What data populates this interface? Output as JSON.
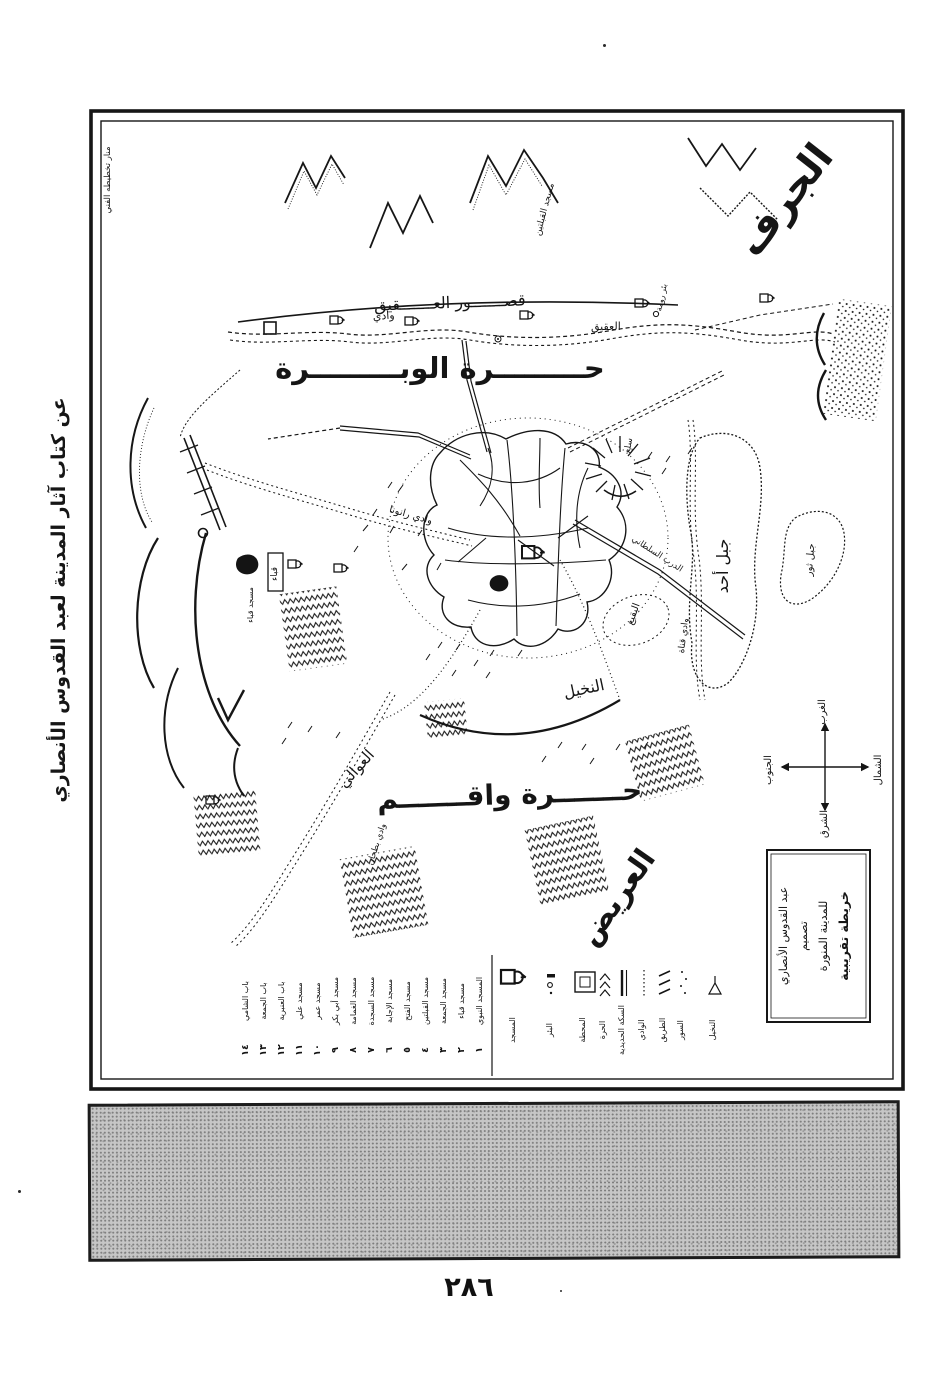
{
  "page": {
    "number": "٢٨٦"
  },
  "colors": {
    "ink": "#1a1a1a",
    "paper": "#ffffff",
    "halftone_bar": "#c6c6c6"
  },
  "margin_caption": "عن كتاب آثار المدينة لعبد القدوس الأنصاري",
  "corner_note": "منار تخطيطه الفني",
  "map": {
    "major_labels": {
      "jurf": "الجرف",
      "qusur_aqiq": "قصـــــــور العـــــــقيق",
      "wadi_word": "وادي",
      "aqiq_word": "العقيق",
      "harrat_wabara": "حـــــــــرة الوبـــــــــرة",
      "harrat_waqim": "حـــــــرة واقـــــــم",
      "awali": "العوالي",
      "arid": "العريض",
      "nakheel": "النخيل",
      "wadi_ranuna": "وادي رانونا",
      "wadi_buthan": "وادي بطحان",
      "wadi_qanat": "وادي قناة",
      "jabal_uhud": "جبل أحد",
      "jabal_thawr": "جبل ثور",
      "jabal_sala": "سلع",
      "quba_box": "قباء",
      "masjid_quba": "مسجد قباء",
      "baqi": "البقيع",
      "qiblatain": "مسجد القبلتين",
      "bir_ruma": "بئر رومة",
      "darb_sultani": "الدرب السلطاني"
    },
    "compass": {
      "north": "الشمال",
      "south": "الجنوب",
      "east": "الشرق",
      "west": "الغرب"
    },
    "cartouche": {
      "line1": "خريطة تقريبية",
      "line2": "للمدينة المنورة",
      "line3": "تصميم",
      "line4": "عبد القدوس الأنصاري"
    },
    "legend": {
      "numbered": [
        {
          "no": "١",
          "label": "المسجد النبوي"
        },
        {
          "no": "٢",
          "label": "مسجد قباء"
        },
        {
          "no": "٣",
          "label": "مسجد الجمعة"
        },
        {
          "no": "٤",
          "label": "مسجد القبلتين"
        },
        {
          "no": "٥",
          "label": "مسجد الفتح"
        },
        {
          "no": "٦",
          "label": "مسجد الإجابة"
        },
        {
          "no": "٧",
          "label": "مسجد السجدة"
        },
        {
          "no": "٨",
          "label": "مسجد الغمامة"
        },
        {
          "no": "٩",
          "label": "مسجد أبي بكر"
        },
        {
          "no": "١٠",
          "label": "مسجد عمر"
        },
        {
          "no": "١١",
          "label": "مسجد علي"
        },
        {
          "no": "١٢",
          "label": "باب العنبرية"
        },
        {
          "no": "١٣",
          "label": "باب الجمعة"
        },
        {
          "no": "١٤",
          "label": "باب الشامي"
        }
      ],
      "symbols": [
        {
          "icon": "mosque-icon",
          "label": "المسجد"
        },
        {
          "icon": "well-icon",
          "label": "البئر"
        },
        {
          "icon": "station-icon",
          "label": "المحطة"
        },
        {
          "icon": "lava-icon",
          "label": "الحرة"
        },
        {
          "icon": "railway-icon",
          "label": "السكة الحديدية"
        },
        {
          "icon": "wadi-icon",
          "label": "الوادي"
        },
        {
          "icon": "road-icon",
          "label": "الطريق"
        },
        {
          "icon": "wall-icon",
          "label": "السور"
        },
        {
          "icon": "palm-icon",
          "label": "النخيل"
        }
      ]
    }
  }
}
